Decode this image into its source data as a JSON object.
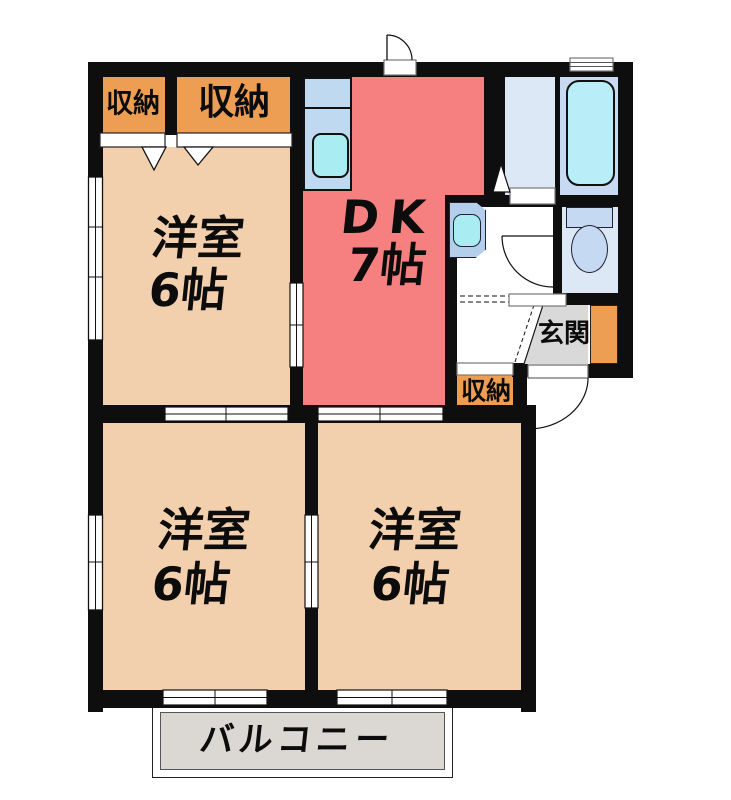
{
  "rooms": {
    "closet_top_small": {
      "label": "収納"
    },
    "closet_top_large": {
      "label": "収納"
    },
    "bedroom_top_left": {
      "name": "洋室",
      "size": "6帖"
    },
    "dining_kitchen": {
      "name": "DK",
      "size": "7帖"
    },
    "closet_middle": {
      "label": "収納"
    },
    "entrance": {
      "label": "玄関"
    },
    "bedroom_bottom_left": {
      "name": "洋室",
      "size": "6帖"
    },
    "bedroom_bottom_right": {
      "name": "洋室",
      "size": "6帖"
    },
    "balcony": {
      "label": "バルコニー"
    }
  },
  "colors": {
    "room_tan": "#f2cfad",
    "closet_orange": "#ee9e53",
    "dk_red": "#f5807f",
    "counter_blue": "#bfd9f0",
    "sink_cyan": "#a9edf3",
    "wet_blue": "#dce8f6",
    "bath_blue": "#c7daf1",
    "tub_cyan": "#b9eef8",
    "fixture_blue": "#c6d9f2",
    "basin_unit_blue": "#b3cfec",
    "genkan_gray": "#d9d9d9",
    "balcony_gray": "#dbd7d2",
    "wall_black": "#0e0e0e"
  }
}
